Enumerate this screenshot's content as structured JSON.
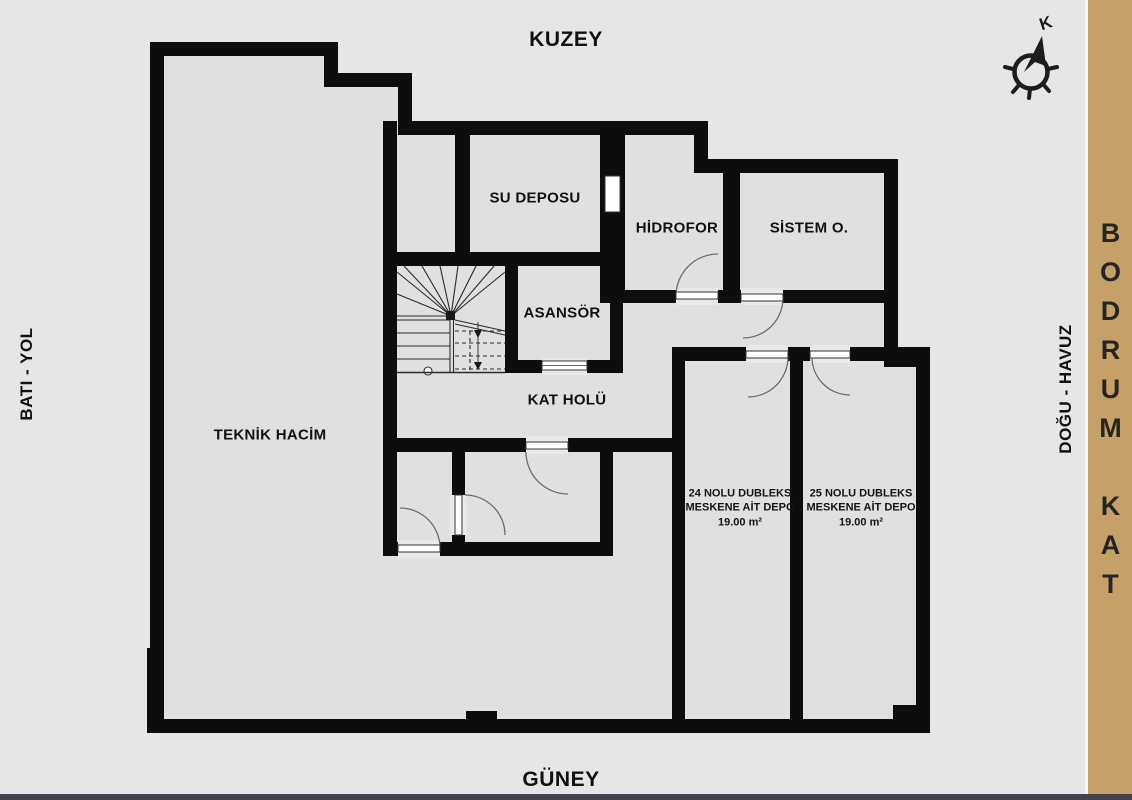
{
  "title": "BODRUM KAT",
  "colors": {
    "page_background": "#e6e5e8",
    "floor": "#e0dfe1",
    "walls": "#0d0d0d",
    "banner": "#c6a069",
    "door_arc": "#6b6b6b",
    "bottom_edge": "#43444b"
  },
  "orientation": {
    "north": "KUZEY",
    "south": "GÜNEY",
    "west": "BATI - YOL",
    "east": "DOĞU - HAVUZ"
  },
  "banner": {
    "text": "BODRUM KAT"
  },
  "compass": {
    "north_letter": "K"
  },
  "rooms": {
    "su_deposu": {
      "label": "SU DEPOSU"
    },
    "hidrofor": {
      "label": "HİDROFOR"
    },
    "sistem_o": {
      "label": "SİSTEM O."
    },
    "asansor": {
      "label": "ASANSÖR"
    },
    "kat_holu": {
      "label": "KAT HOLÜ"
    },
    "teknik_hacim": {
      "label": "TEKNİK HACİM"
    },
    "depo_24": {
      "lines": [
        "24 NOLU DUBLEKS",
        "MESKENE AİT DEPO",
        "19.00 m²"
      ]
    },
    "depo_25": {
      "lines": [
        "25 NOLU DUBLEKS",
        "MESKENE AİT DEPO",
        "19.00 m²"
      ]
    }
  }
}
